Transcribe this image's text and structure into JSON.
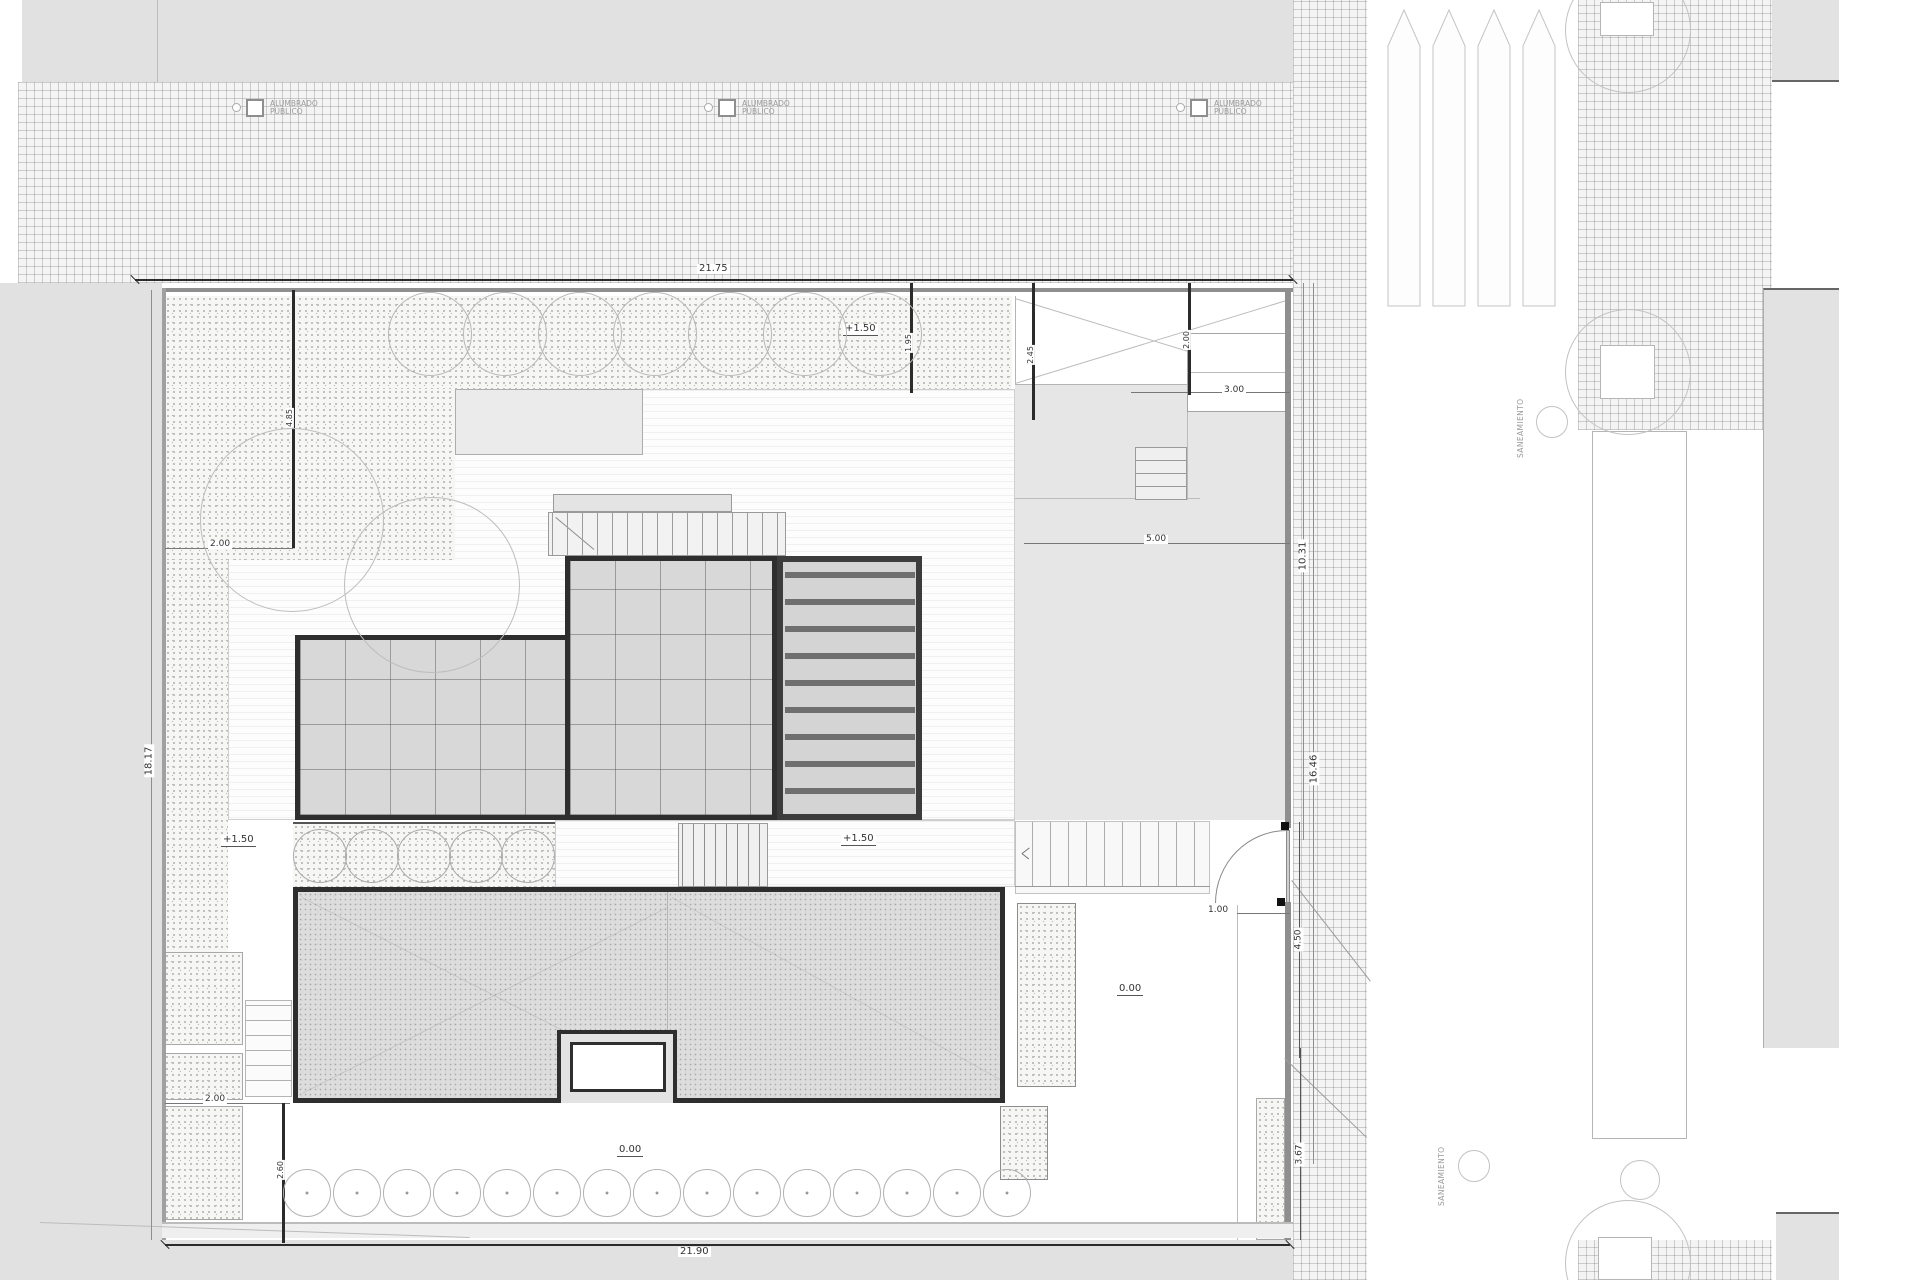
{
  "dimensions": {
    "plot_top": "21.75",
    "plot_bottom": "21.90",
    "plot_left": "18.17",
    "sidewalk_upper": "10.31",
    "sidewalk_lower": "16.46",
    "gate_side": "4.50",
    "corner_side": "3.67",
    "terrace_top": "3.00",
    "gate_width": "1.00",
    "terrace_width": "5.00",
    "garden_top_width": "2.00",
    "garden_bottom_width": "2.00",
    "garden_left_depth": "4.85",
    "setback_a": "1.95",
    "setback_b": "2.45",
    "setback_c": "2.00",
    "corner_inner": "2.60"
  },
  "levels": {
    "upper": "+1.50",
    "ground": "0.00"
  },
  "street": {
    "light_line1": "ALUMBRADO",
    "light_line2": "PÚBLICO",
    "sewer_label": "SANEAMIENTO"
  }
}
